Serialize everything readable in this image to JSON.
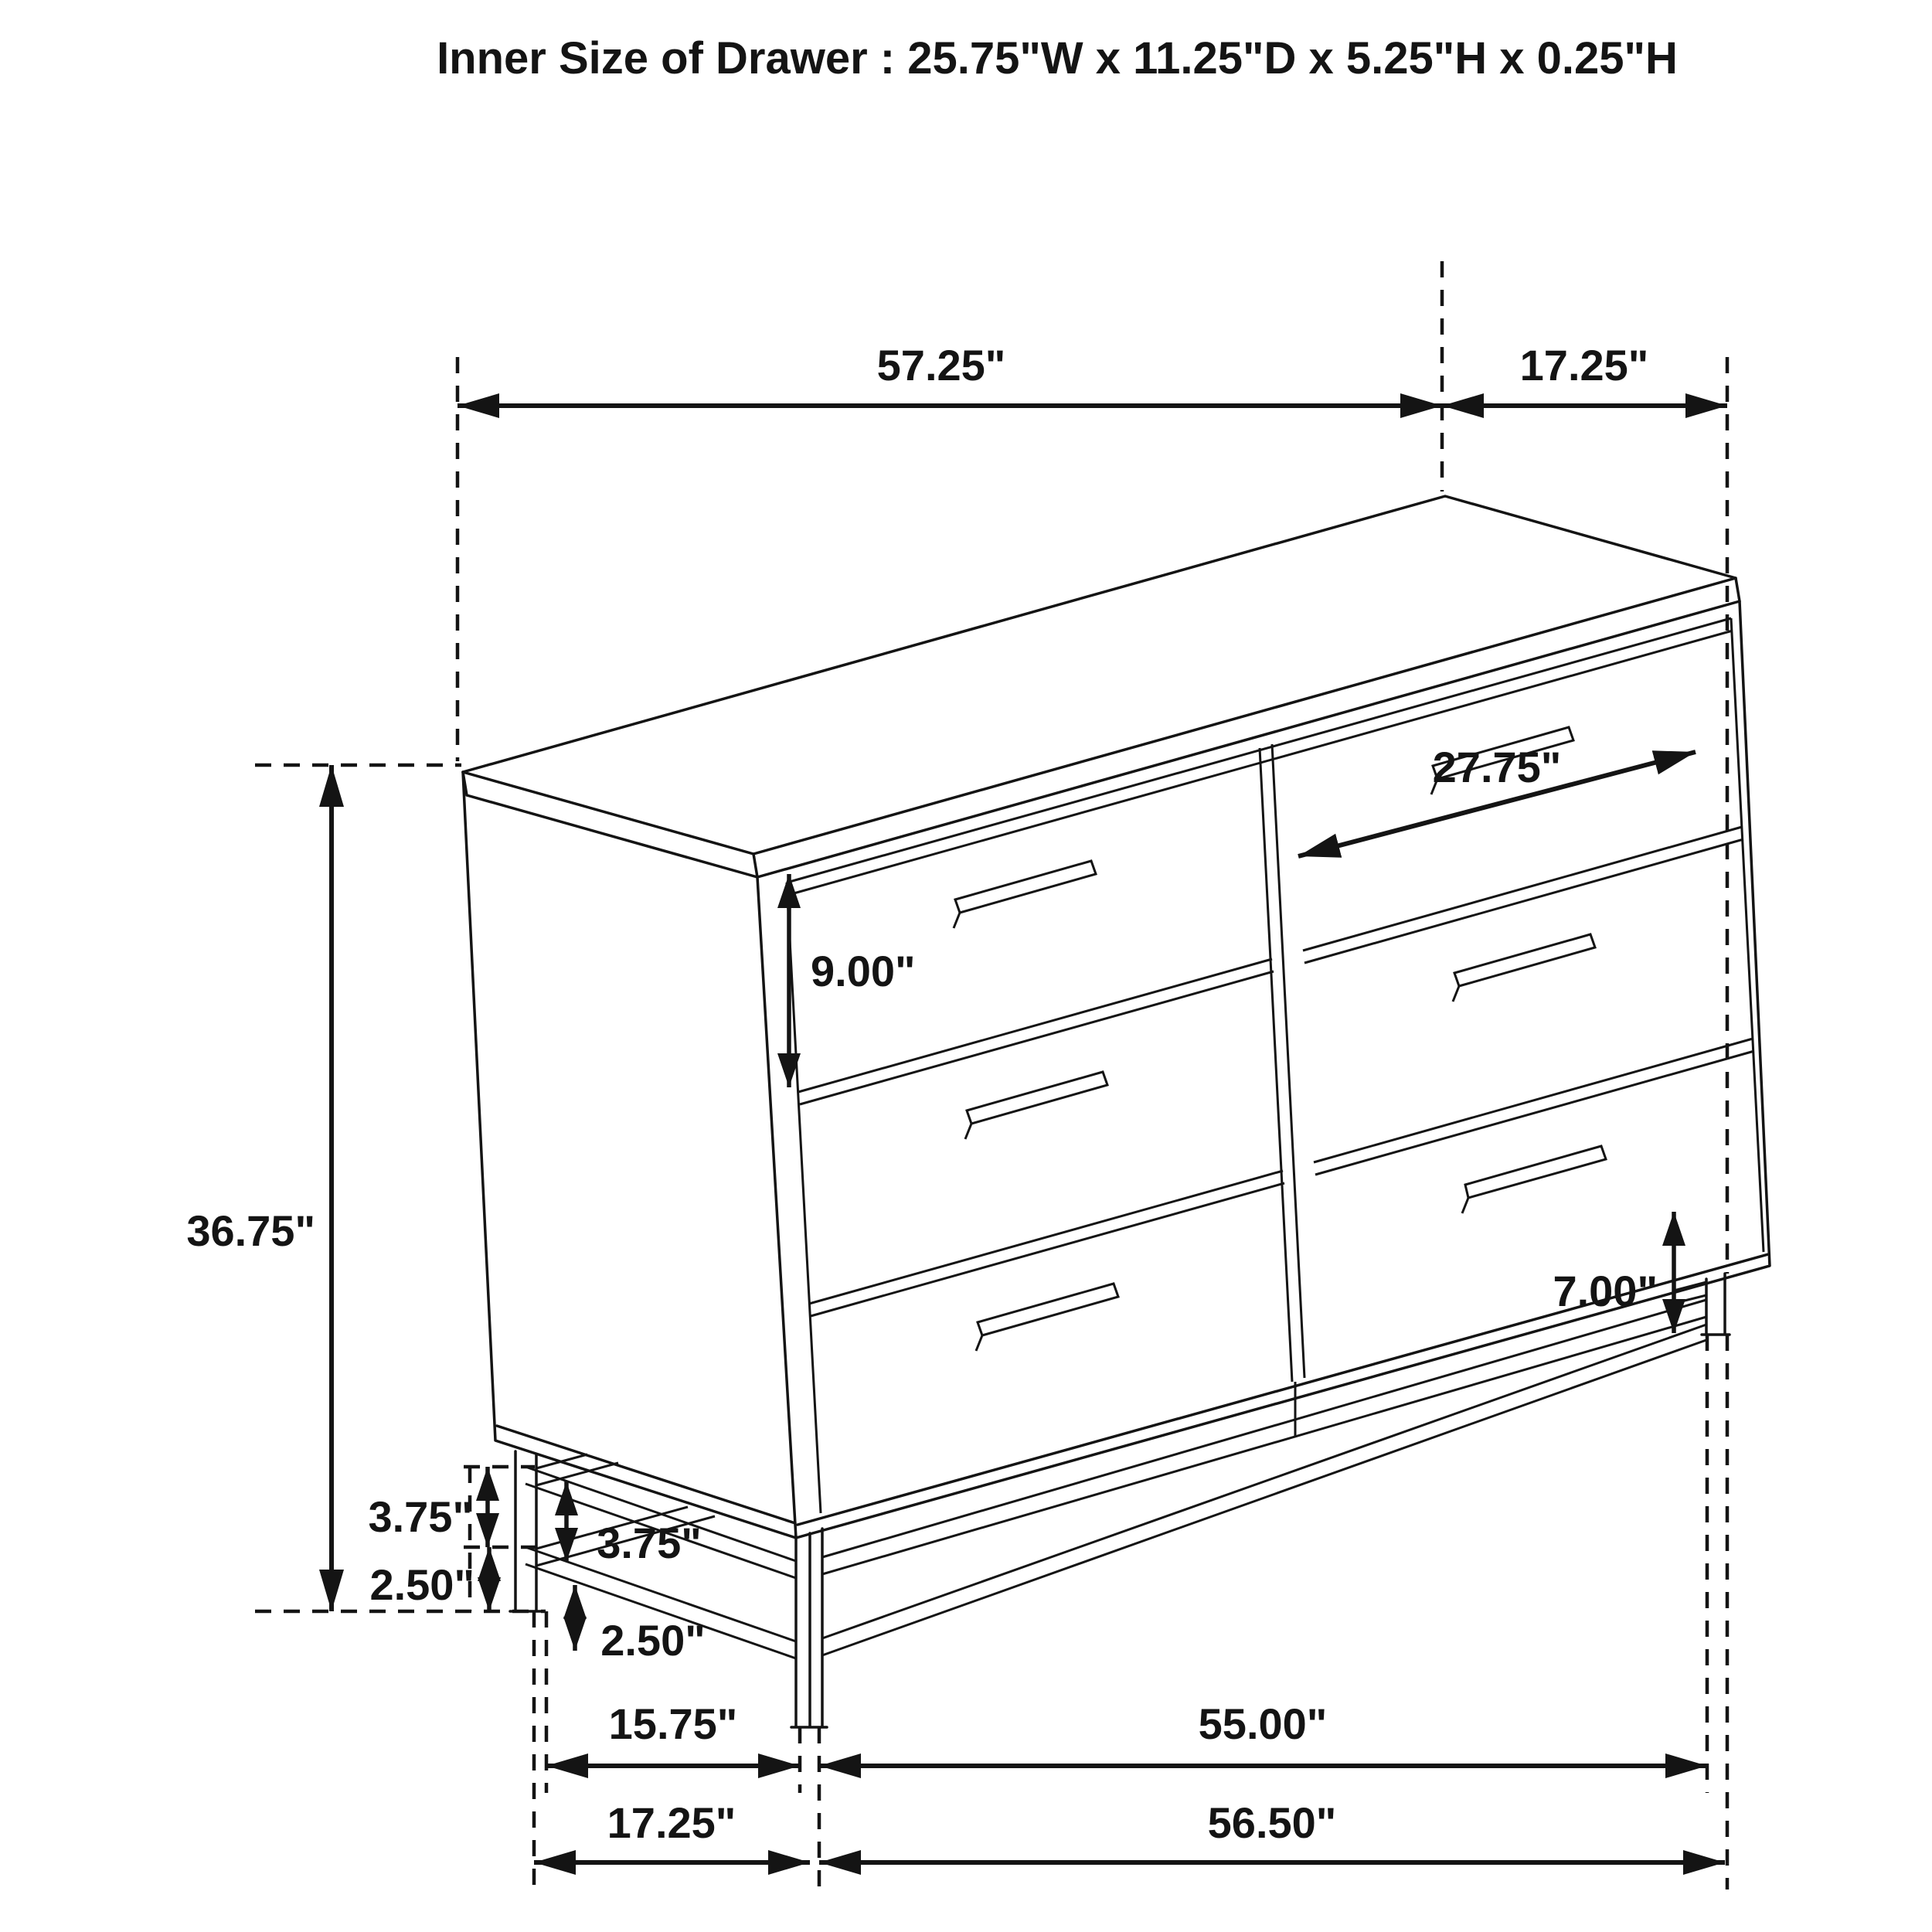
{
  "title": "Inner Size of Drawer : 25.75\"W x 11.25\"D x 5.25\"H x 0.25\"H",
  "dimensions": {
    "overall_width": "57.25\"",
    "overall_depth": "17.25\"",
    "overall_height": "36.75\"",
    "drawer_front_height": "9.00\"",
    "drawer_width_diagonal": "27.75\"",
    "leg_height": "7.00\"",
    "left_frame_upper": "3.75\"",
    "left_frame_lower": "2.50\"",
    "leg_frame_upper": "3.75\"",
    "leg_frame_lower": "2.50\"",
    "base_depth": "15.75\"",
    "base_width": "55.00\"",
    "bottom_depth": "17.25\"",
    "bottom_width": "56.50\""
  }
}
